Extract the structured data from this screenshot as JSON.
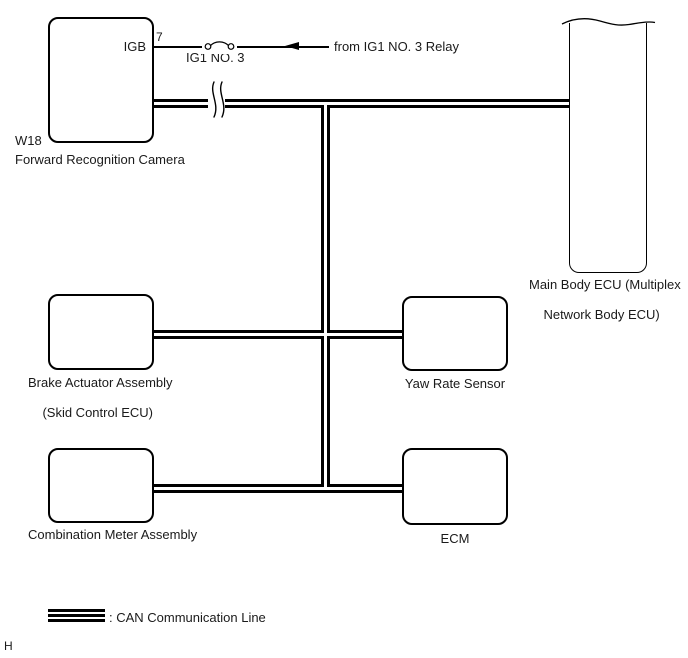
{
  "page": {
    "background": "#ffffff",
    "line_color": "#000000",
    "text_color": "#1a1a1a",
    "footer_letter": "H"
  },
  "nodes": {
    "forward_recognition_camera": {
      "code": "W18",
      "label": "Forward Recognition Camera",
      "terminal_name": "IGB",
      "terminal_pin": "7"
    },
    "main_body_ecu": {
      "label_line1": "Main Body ECU (Multiplex",
      "label_line2": "Network Body ECU)"
    },
    "brake_actuator": {
      "label_line1": "Brake Actuator Assembly",
      "label_line2": "(Skid Control ECU)"
    },
    "yaw_rate_sensor": {
      "label": "Yaw Rate Sensor"
    },
    "combination_meter": {
      "label": "Combination Meter Assembly"
    },
    "ecm": {
      "label": "ECM"
    }
  },
  "power_feed": {
    "fuse_label": "IG1 NO. 3",
    "source_label": "from IG1 NO. 3 Relay"
  },
  "legend": {
    "label": ": CAN Communication Line"
  }
}
